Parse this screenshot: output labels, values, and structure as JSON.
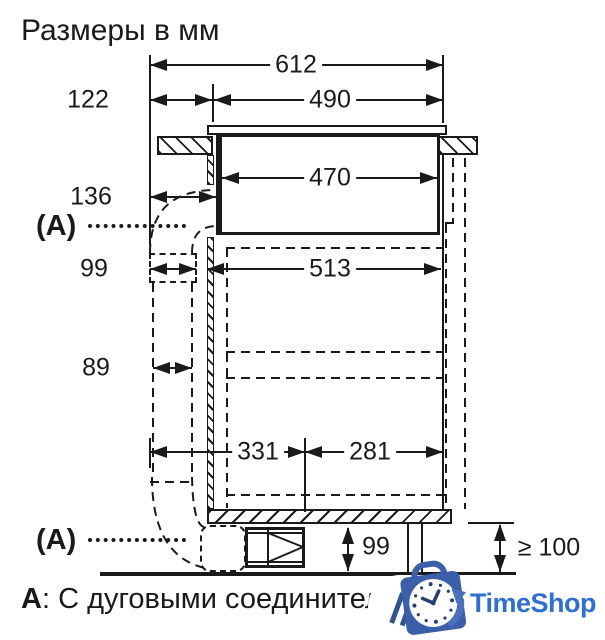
{
  "title": "Размеры в мм",
  "dims": {
    "total": "612",
    "front_offset": "122",
    "cutout_depth": "490",
    "body_depth": "470",
    "left_clearance": "136",
    "duct_coupling_width": "99",
    "lower_body_depth": "513",
    "duct_width": "89",
    "rear_span": "331",
    "front_span": "281",
    "outlet_height": "99",
    "plinth_min_height": "≥ 100"
  },
  "callouts": {
    "top": "(A)",
    "bottom": "(A)"
  },
  "note": {
    "label": "А",
    "text": ": С дуговыми соединителям"
  },
  "watermark": {
    "brand": "TimeShop",
    "text_color": "#2f6fce",
    "bag_color": "#3b5fa8"
  },
  "colors": {
    "line": "#1a1a1a",
    "background": "#ffffff"
  }
}
